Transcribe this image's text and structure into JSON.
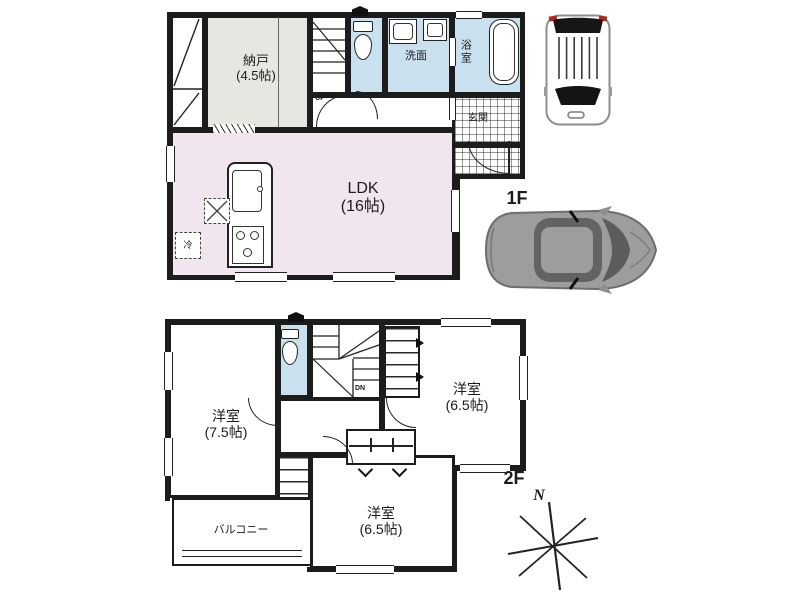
{
  "floor1": {
    "label": "1F",
    "stairs_label": "UP",
    "rooms": {
      "storage": {
        "name": "納戸",
        "size": "(4.5帖)"
      },
      "ldk": {
        "name": "LDK",
        "size": "(16帖)"
      },
      "washroom": {
        "name": "洗面"
      },
      "bathroom": {
        "name": "浴室"
      },
      "entrance": {
        "name": "玄関"
      },
      "refrigerator": {
        "name": "冷"
      }
    }
  },
  "floor2": {
    "label": "2F",
    "stairs_label": "DN",
    "rooms": {
      "bedroom_west": {
        "name": "洋室",
        "size": "(7.5帖)"
      },
      "bedroom_east": {
        "name": "洋室",
        "size": "(6.5帖)"
      },
      "bedroom_south": {
        "name": "洋室",
        "size": "(6.5帖)"
      },
      "balcony": {
        "name": "バルコニー"
      }
    }
  },
  "compass": {
    "north": "N"
  },
  "colors": {
    "wall": "#1c1c1c",
    "ldk_fill": "#f1e5f0",
    "storage_fill": "#e4e8e0",
    "wet_area_fill": "#c9e1ee",
    "page_bg": "#ffffff",
    "car_gray": "#9d9d9d"
  }
}
